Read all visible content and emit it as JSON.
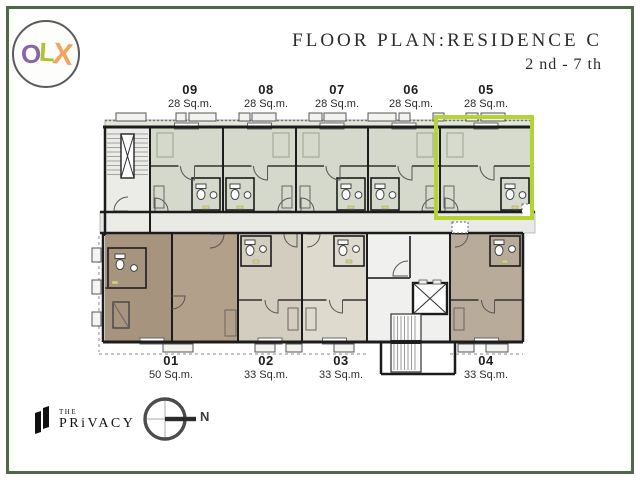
{
  "header": {
    "title": "FLOOR PLAN:RESIDENCE C",
    "subtitle": "2 nd - 7 th"
  },
  "watermark": {
    "o": "O",
    "l": "L",
    "x": "X",
    "o_color": "#8a63a8",
    "l_color": "#b3c32f",
    "x_color": "#f2a35e"
  },
  "brand": {
    "top": "THE",
    "name": "PRiVACY"
  },
  "compass": {
    "label": "N"
  },
  "frame_color": "#4d6b44",
  "plan": {
    "highlighted_unit": "05",
    "highlight_color": "#b5d333",
    "wall_color": "#1c1c1c",
    "corridor_color": "#e9e9e6",
    "stairwell_fill": "#ebebe8",
    "core_fill": "#f0f0ee",
    "accent_fixture_color": "#d9d46e",
    "top_units": [
      {
        "number": "09",
        "area": "28 Sq.m.",
        "x": 150,
        "w": 73,
        "bath": "right",
        "fill": "#d4d9cb",
        "label_x": 190
      },
      {
        "number": "08",
        "area": "28 Sq.m.",
        "x": 223,
        "w": 73,
        "bath": "left",
        "fill": "#d4d9cb",
        "label_x": 266
      },
      {
        "number": "07",
        "area": "28 Sq.m.",
        "x": 296,
        "w": 72,
        "bath": "right",
        "fill": "#d4d9cb",
        "label_x": 337
      },
      {
        "number": "06",
        "area": "28 Sq.m.",
        "x": 368,
        "w": 72,
        "bath": "left",
        "fill": "#d4d9cb",
        "label_x": 411
      },
      {
        "number": "05",
        "area": "28 Sq.m.",
        "x": 440,
        "w": 92,
        "bath": "right",
        "fill": "#d6dbce",
        "label_x": 486,
        "highlighted": true
      }
    ],
    "bottom_units": [
      {
        "number": "01",
        "area": "50 Sq.m.",
        "x": 105,
        "w": 133,
        "custom": "unit01",
        "fill": "#a7947f",
        "fill2": "#b2a08b",
        "label_x": 171
      },
      {
        "number": "02",
        "area": "33 Sq.m.",
        "x": 238,
        "w": 64,
        "bath": "left",
        "fill": "#d2cdbf",
        "label_x": 266
      },
      {
        "number": "03",
        "area": "33 Sq.m.",
        "x": 302,
        "w": 65,
        "bath": "right",
        "fill": "#dedacd",
        "label_x": 341
      },
      {
        "number": "04",
        "area": "33 Sq.m.",
        "x": 450,
        "w": 73,
        "bath": "right",
        "fill": "#b9ab99",
        "label_x": 486
      }
    ]
  }
}
